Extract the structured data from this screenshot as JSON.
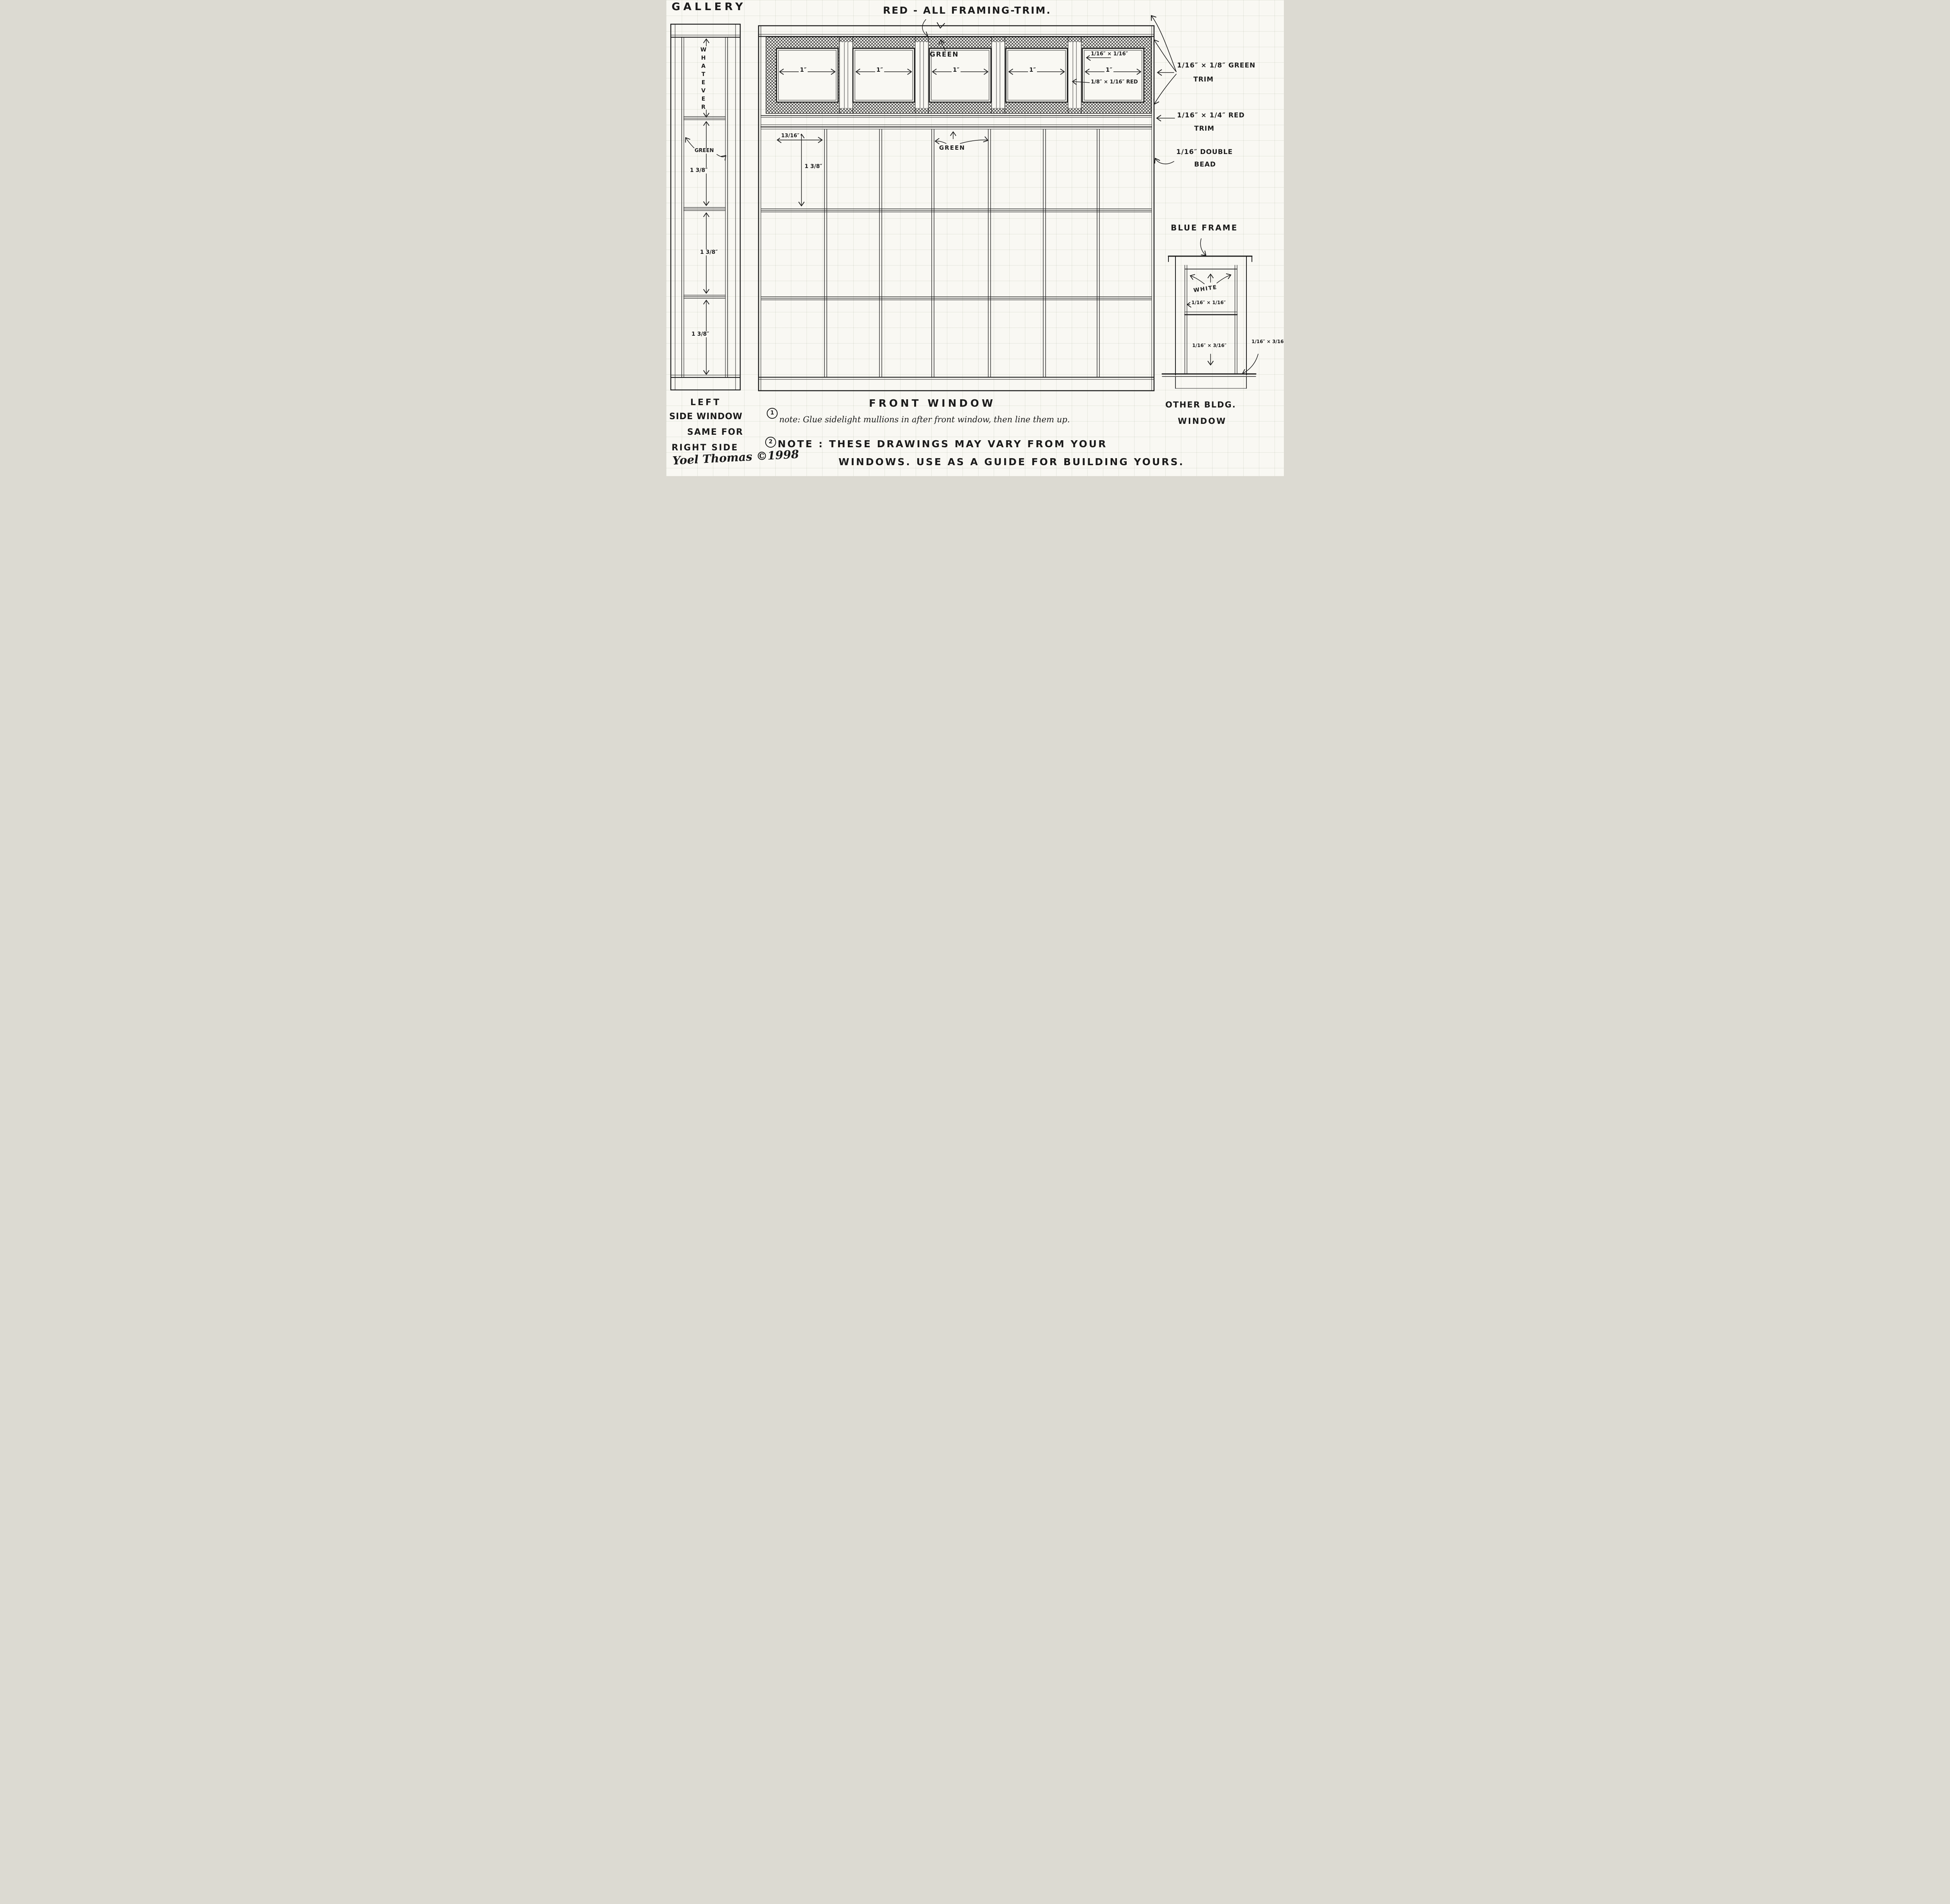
{
  "page": {
    "gallery_title": "GALLERY",
    "top_annotation": "RED - ALL FRAMING-TRIM."
  },
  "colors": {
    "ink": "#1b1b1b",
    "paper": "#f9f8f3"
  },
  "left_window": {
    "whatever_label": "WHATEVER",
    "green_label": "GREEN",
    "dims": [
      "1 3/8″",
      "1 3/8″",
      "1 3/8″"
    ],
    "caption_lines": [
      "LEFT",
      "SIDE WINDOW",
      "SAME FOR",
      "RIGHT SIDE"
    ]
  },
  "front_window": {
    "caption": "FRONT WINDOW",
    "transom": {
      "green_label": "GREEN",
      "pane_width_labels": [
        "1″",
        "1″",
        "1″",
        "1″",
        "1″"
      ],
      "inner_trim_label": "1/16″ × 1/16″",
      "mullion_trim_label": "1/8″ × 1/16″ RED"
    },
    "grid": {
      "green_label": "GREEN",
      "mullion_spacing_label": "13/16″",
      "row_height_label": "1 3/8″"
    }
  },
  "annotations": {
    "green_trim": [
      "1/16″ × 1/8″ GREEN",
      "TRIM"
    ],
    "red_trim": [
      "1/16″ × 1/4″ RED",
      "TRIM"
    ],
    "double_bead": [
      "1/16″ DOUBLE",
      "BEAD"
    ]
  },
  "other_window": {
    "frame_label": "BLUE FRAME",
    "white_label": "WHITE",
    "glazing_bar_label": "1/16″ × 1/16″",
    "lower_bar_label": "1/16″ × 3/16″",
    "sill_label": "1/16″ × 3/16″",
    "caption_lines": [
      "OTHER BLDG.",
      "WINDOW"
    ]
  },
  "notes": {
    "note1_num": "1",
    "note1_text": "note: Glue sidelight mullions in after front window, then line them up.",
    "note2_num": "2",
    "note2_line1": "NOTE : THESE DRAWINGS MAY VARY FROM YOUR",
    "note2_line2": "WINDOWS. USE AS A GUIDE FOR BUILDING YOURS."
  },
  "signature": {
    "text": "Yoel Thomas ©1998"
  }
}
